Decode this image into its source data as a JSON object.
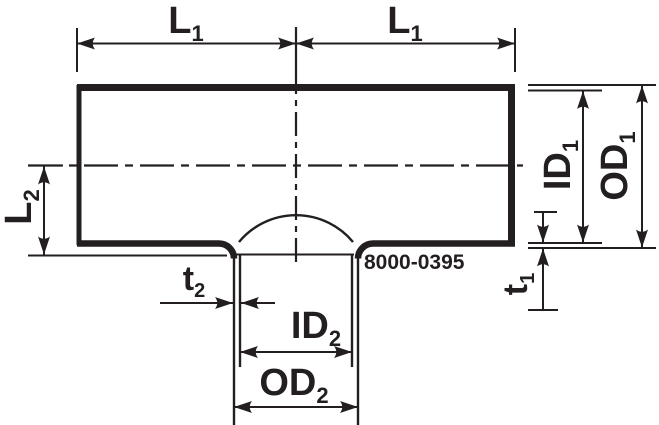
{
  "drawing": {
    "part_number": "8000-0395",
    "colors": {
      "ink": "#231f20",
      "paper": "#ffffff"
    },
    "labels": {
      "l1_left": {
        "base": "L",
        "sub": "1"
      },
      "l1_right": {
        "base": "L",
        "sub": "1"
      },
      "l2": {
        "base": "L",
        "sub": "2"
      },
      "id1": {
        "base": "ID",
        "sub": "1"
      },
      "od1": {
        "base": "OD",
        "sub": "1"
      },
      "t1": {
        "base": "t",
        "sub": "1"
      },
      "t2": {
        "base": "t",
        "sub": "2"
      },
      "id2": {
        "base": "ID",
        "sub": "2"
      },
      "od2": {
        "base": "OD",
        "sub": "2"
      }
    }
  }
}
